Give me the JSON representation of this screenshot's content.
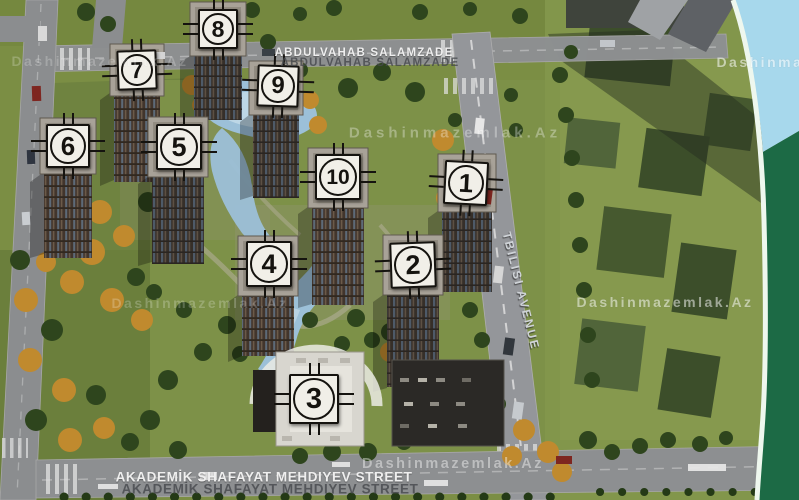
{
  "scene": {
    "width": 799,
    "height": 500
  },
  "streets": {
    "top": {
      "label": "ABDULVAHAB SALAMZADE"
    },
    "bottom": {
      "label": "AKADEMİK SHAFAYAT MEHDIYEV STREET"
    },
    "avenue": {
      "label": "TBILISI AVENUE"
    }
  },
  "watermark": {
    "text": "Dashinmazemlak.Az",
    "instances": [
      {
        "x": 100,
        "y": 61,
        "opacity": 0.22,
        "size": 14,
        "spacing": 2.5
      },
      {
        "x": 805,
        "y": 62,
        "opacity": 0.55,
        "size": 14,
        "spacing": 2.5
      },
      {
        "x": 455,
        "y": 133,
        "opacity": 0.32,
        "size": 15,
        "spacing": 4
      },
      {
        "x": 200,
        "y": 303,
        "opacity": 0.22,
        "size": 14,
        "spacing": 2.5
      },
      {
        "x": 665,
        "y": 302,
        "opacity": 0.5,
        "size": 14,
        "spacing": 2.5
      },
      {
        "x": 453,
        "y": 464,
        "opacity": 0.42,
        "size": 14.5,
        "spacing": 2.5
      }
    ]
  },
  "markers": [
    {
      "label": "8",
      "cx": 218,
      "cy": 29,
      "size": 40,
      "rot": 0
    },
    {
      "label": "7",
      "cx": 137,
      "cy": 70,
      "size": 40,
      "rot": -2
    },
    {
      "label": "9",
      "cx": 278,
      "cy": 86,
      "size": 42,
      "rot": 2
    },
    {
      "label": "6",
      "cx": 68,
      "cy": 146,
      "size": 44,
      "rot": 0
    },
    {
      "label": "5",
      "cx": 179,
      "cy": 147,
      "size": 46,
      "rot": 0
    },
    {
      "label": "10",
      "cx": 338,
      "cy": 177,
      "size": 46,
      "rot": 0
    },
    {
      "label": "1",
      "cx": 466,
      "cy": 183,
      "size": 44,
      "rot": 3
    },
    {
      "label": "4",
      "cx": 269,
      "cy": 264,
      "size": 46,
      "rot": 0
    },
    {
      "label": "2",
      "cx": 413,
      "cy": 265,
      "size": 46,
      "rot": -2
    },
    {
      "label": "3",
      "cx": 314,
      "cy": 399,
      "size": 50,
      "rot": 0
    }
  ],
  "colors": {
    "road_grey": "#8f9193",
    "grass_green": "#7b8e44",
    "water_blue": "#9cc0d8",
    "tree_green": "#2e451d",
    "autumn_orange": "#c08a2e",
    "tower_dark": "#362f29",
    "ribbon_blue": "#a7d8ec",
    "ribbon_green": "#1c6a45",
    "marker_face": "#f1efe8",
    "marker_line": "#15130f",
    "label_white": "#efefef",
    "label_shadow_grey": "#46494d",
    "watermark_white": "#ffffff"
  }
}
